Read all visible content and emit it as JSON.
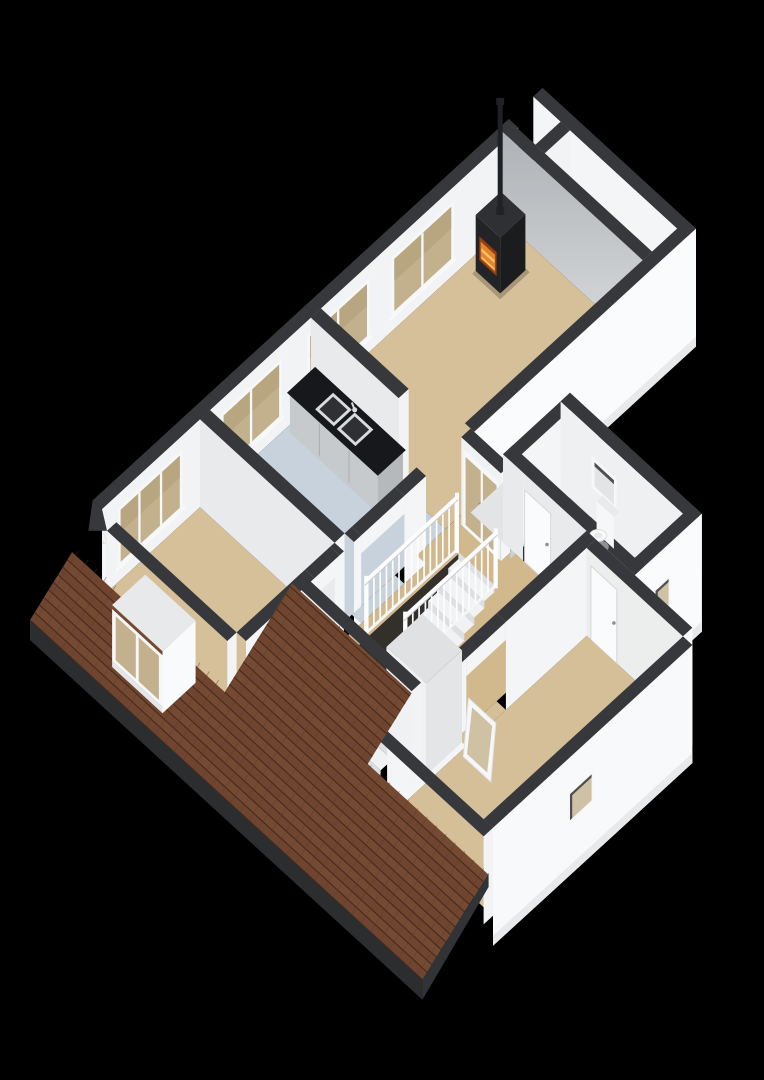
{
  "scene": {
    "background": "#000000",
    "view": "isometric-3d-floor-plan"
  },
  "rooms": [
    {
      "key": "living_room",
      "name": "living-room",
      "floor_color": "#d6c09a"
    },
    {
      "key": "kitchen",
      "name": "kitchen",
      "floor_color": "#c8d2dc"
    },
    {
      "key": "bedroom_left",
      "name": "bedroom-left",
      "floor_color": "#d6c09a"
    },
    {
      "key": "landing",
      "name": "landing-hall",
      "floor_color": "#d2b88d"
    },
    {
      "key": "wc",
      "name": "toilet-room",
      "floor_color": "#e9ebeb"
    },
    {
      "key": "storage",
      "name": "storage-room",
      "floor_color": "#dfe1e2"
    },
    {
      "key": "bedroom_rear",
      "name": "bedroom-rear",
      "floor_color": "#d4bf99"
    },
    {
      "key": "side_gallery",
      "name": "side-gallery-strip",
      "floor_color": "#eef0f1"
    },
    {
      "key": "balcony_ledge",
      "name": "balcony-ledge",
      "floor_color": "#e3e4e6"
    }
  ],
  "fixtures": [
    {
      "name": "wood-stove",
      "color": "#232428",
      "fire": "#e2872f"
    },
    {
      "name": "chimney-pipe",
      "color": "#202124"
    },
    {
      "name": "kitchen-counter",
      "front": "#c6cacd",
      "top": "#17181b"
    },
    {
      "name": "double-sink",
      "steel": "#d9dcde",
      "basin": "#2e3033"
    },
    {
      "name": "staircase",
      "tread": "#f1f2f4",
      "riser": "#dde0e3"
    },
    {
      "name": "stair-railing",
      "color": "#fdfdfe"
    },
    {
      "name": "french-doors",
      "glass": "#c6b58e"
    },
    {
      "name": "interior-door",
      "color": "#fafbfc"
    },
    {
      "name": "wc-door",
      "color": "#fafbfc"
    },
    {
      "name": "toilet",
      "color": "#fafbfc"
    },
    {
      "name": "dormer-window",
      "glass": "#c3b28c"
    },
    {
      "name": "leaning-window-frame",
      "glass": "#cbbc96"
    },
    {
      "name": "roof",
      "color": "#6f4530"
    },
    {
      "name": "facade-windows",
      "glass": "#c2b18c",
      "count": 4
    },
    {
      "name": "small-exterior-windows",
      "count": 3
    }
  ],
  "colors": {
    "background": "#000000",
    "wall_top": "#37383b",
    "wall_top_dark": "#2c2d2f",
    "wall_bright": "#f2f3f4",
    "wall_white": "#f4f5f6",
    "wall_light": "#e9eaec",
    "wall_band": "#fafbfc",
    "wall_band_shade": "#e8e9eb",
    "wall_grad_top": "#aeb1b5",
    "wall_grad_bot": "#d9dbdd",
    "gallery_shade": "#d4d7d9",
    "roof_base": "#6f4530",
    "roof_alt": "#754a33",
    "roof_line": "#4a2b1d",
    "roof_joint": "#5d3827",
    "roof_fascia": "#2c2d2f",
    "roof_verge": "#323336",
    "stove_body": "#232428",
    "stove_side": "#1b1c1e",
    "stove_top": "#2f3033",
    "fire_deep": "#953f10",
    "fire": "#e2872f",
    "fire_hi": "#ffc46b",
    "counter_front": "#c6cacd",
    "counter_side": "#b5b9bc",
    "counter_top": "#17181b",
    "counter_seam": "#a9adb0",
    "sink_steel": "#d9dcde",
    "sink_basin": "#2e3033",
    "glass_tan": "#c2b18c",
    "glass_tan_dk": "#b7a67f",
    "glass_pale": "#cfc2a4",
    "glass_light": "#e2e4e6",
    "frame_white": "#f6f7f8",
    "sill": "#fafafa",
    "reveal_dark": "#4e4f52",
    "stair_tread": "#f1f2f4",
    "stair_riser": "#dde0e3",
    "stair_hole": "#332f2b",
    "railing": "#fdfdfe",
    "railing_shade": "#c9cbce",
    "door_white": "#fafbfc",
    "door_edge": "#d6d8da",
    "handle": "#8e9194",
    "toilet_white": "#fafbfc",
    "toilet_shadow": "#c9ccce",
    "closet_face": "#f0f1f3",
    "closet_side": "#e3e5e7",
    "closet_top": "#e0e1e3",
    "ledge_top": "#e3e4e6",
    "ledge_face": "#cdd0d2",
    "shadow": "#000000"
  }
}
